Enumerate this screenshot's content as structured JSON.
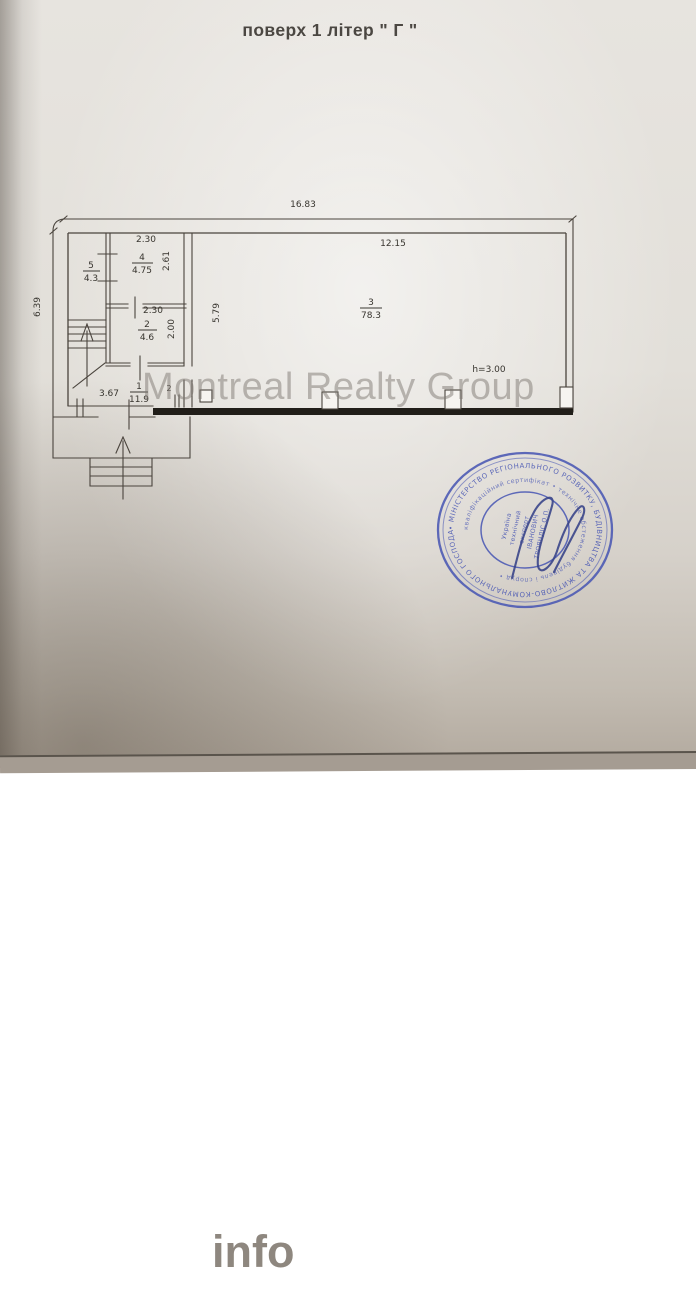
{
  "page": {
    "title": "поверх 1 літер \" Г \""
  },
  "plan": {
    "dims": {
      "overall_width": "16.83",
      "overall_height": "6.39",
      "room3_width": "12.15",
      "room3_depth": "5.79",
      "room4_width": "2.30",
      "room4_depth": "2.61",
      "room2_width": "2.30",
      "room2_depth": "2.00",
      "entry_width": "3.67",
      "ceiling_height": "h=3.00",
      "door_mark": "2"
    },
    "rooms": [
      {
        "num": "5",
        "area": "4.3"
      },
      {
        "num": "4",
        "area": "4.75"
      },
      {
        "num": "2",
        "area": "4.6"
      },
      {
        "num": "1",
        "area": "11.9"
      },
      {
        "num": "3",
        "area": "78.3"
      }
    ]
  },
  "watermark": {
    "text": "Montreal Realty Group"
  },
  "stamp": {
    "ring_text": "• МІНІСТЕРСТВО РЕГІОНАЛЬНОГО РОЗВИТКУ, БУДІВНИЦТВА ТА ЖИТЛОВО-КОМУНАЛЬНОГО ГОСПОДАРСТВА УКРАЇНИ",
    "inner_ring_text": "кваліфікаційний сертифікат • технічне обстеження будівель і споруд •",
    "center_lines": [
      "Україна",
      "технічний",
      "експерт",
      "ІВАНОВИЧ",
      "ТРОЯНДІС О.П."
    ],
    "color": "#4a58b4"
  },
  "logo": {
    "dom": "DOM",
    "pliz": "Pliz",
    "info": "info"
  },
  "colors": {
    "stamp_blue": "#4a58b4",
    "ink": "#38352f",
    "paper": "#e0dcd6",
    "wall_black": "#211e19"
  }
}
